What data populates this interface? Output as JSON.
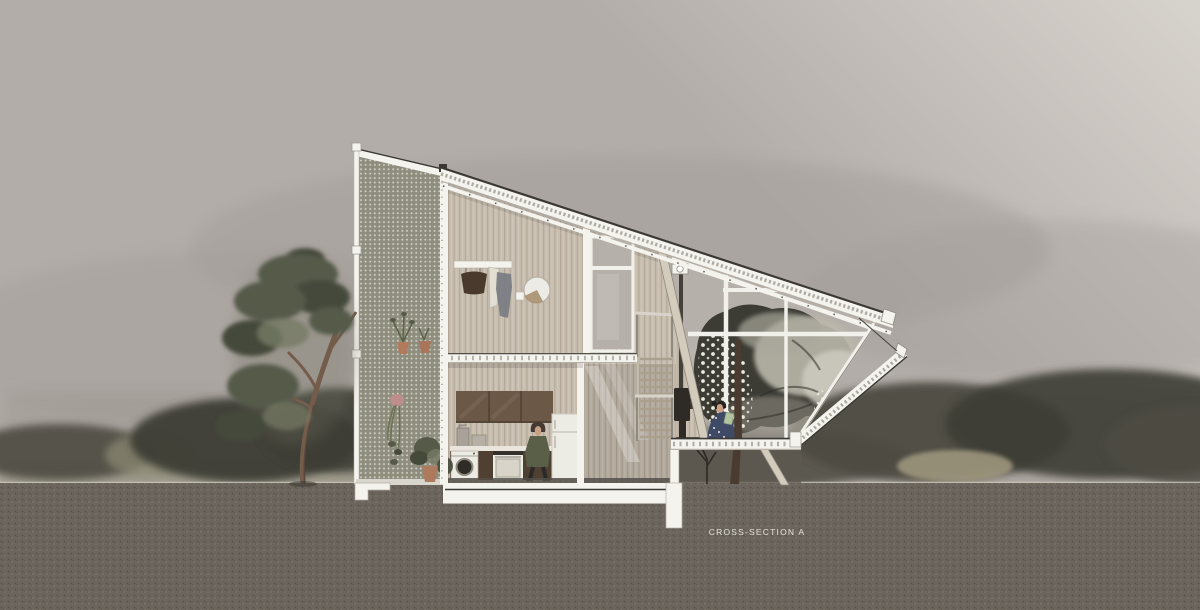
{
  "label": {
    "title": "CROSS-SECTION A"
  },
  "palette": {
    "sky_left": "#b3ada9",
    "sky_right": "#d7d3cd",
    "sky_mid": "#a39d99",
    "horizon_haze": "#908b83",
    "bush_dark": "#3e3d34",
    "bush_mid": "#4d4c42",
    "grass": "#8e8c74",
    "hay": "#a29a80",
    "ground": "#6b655d",
    "frame_white": "#f4f3ee",
    "frame_dark": "#3b3833",
    "screen_fill": "#8f8e7e",
    "screen_dot": "#e9e8e0",
    "wall": "#c8beb0",
    "glass": "#c1bcb5",
    "mullion": "#f2f0eb",
    "cut_beige": "#d3ccbd",
    "cabinet": "#6b5847",
    "cabinet_deep": "#4f4032",
    "counter": "#e9e5dd",
    "appliance": "#ecebe4",
    "steel": "#8f8a80",
    "coat_green": "#596047",
    "skin": "#c9a185",
    "hair_dark": "#463931",
    "denim": "#3e4a66",
    "book_green": "#b3c4a0",
    "tree_dark": "#454a3b",
    "tree_mid": "#555a49",
    "tree_light": "#767b64",
    "trunk": "#745c4b",
    "trunk_dark": "#504035",
    "canopy_dark": "#3c3b34",
    "canopy_light": "#bab7aa",
    "canopy_dot": "#eceade",
    "floor_dark": "#55504a",
    "under_shadow": "#5d5850",
    "label_color": "#e5e3dc"
  }
}
